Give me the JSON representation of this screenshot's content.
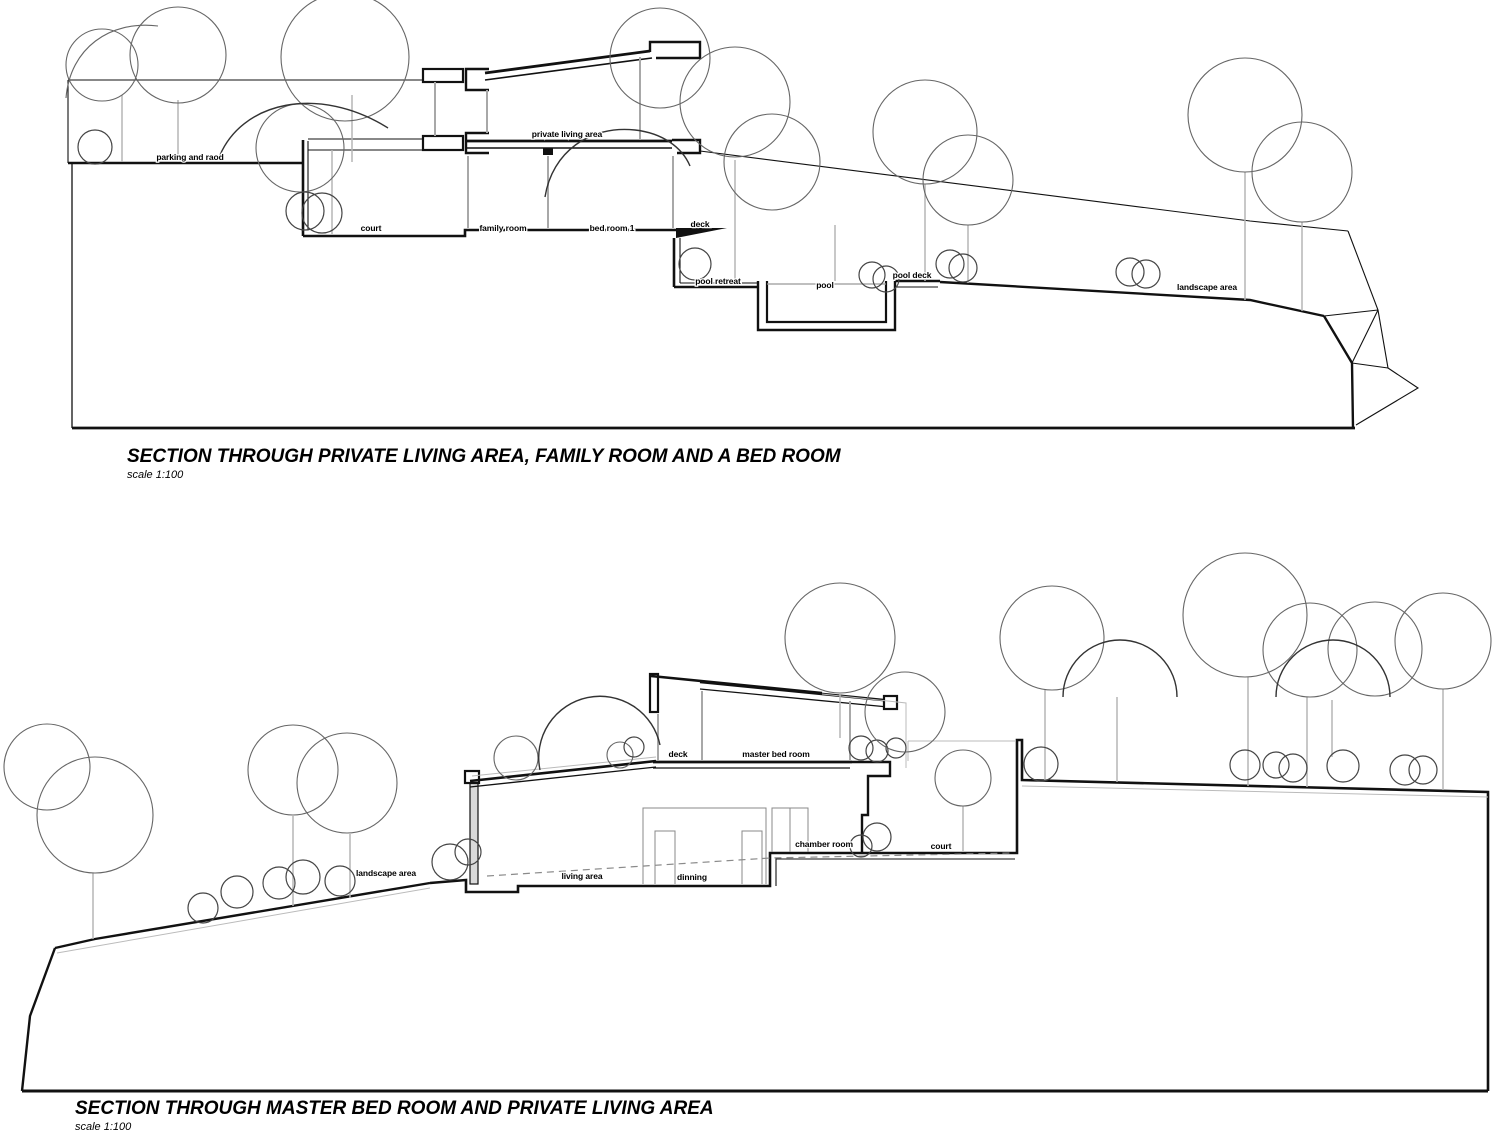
{
  "meta": {
    "drawing_type": "architectural sections",
    "background_color": "#ffffff",
    "line_color": "#111111",
    "light_line_color": "#a8a8a8"
  },
  "section_1": {
    "title": "SECTION THROUGH PRIVATE LIVING AREA, FAMILY ROOM AND A BED ROOM",
    "scale": "scale 1:100",
    "labels": {
      "parking": "parking and raod",
      "private_living": "private living area",
      "court": "court",
      "family_room": "family room",
      "bed_room_1": "bed room 1",
      "deck": "deck",
      "pool_retreat": "pool retreat",
      "pool": "pool",
      "pool_deck": "pool deck",
      "landscape": "landscape area"
    }
  },
  "section_2": {
    "title": "SECTION THROUGH MASTER BED ROOM AND PRIVATE LIVING AREA",
    "scale": "scale 1:100",
    "labels": {
      "landscape": "landscape area",
      "deck": "deck",
      "master_bed_room": "master bed room",
      "chamber_room": "chamber room",
      "court": "court",
      "living_area": "living area",
      "dinning": "dinning"
    }
  }
}
